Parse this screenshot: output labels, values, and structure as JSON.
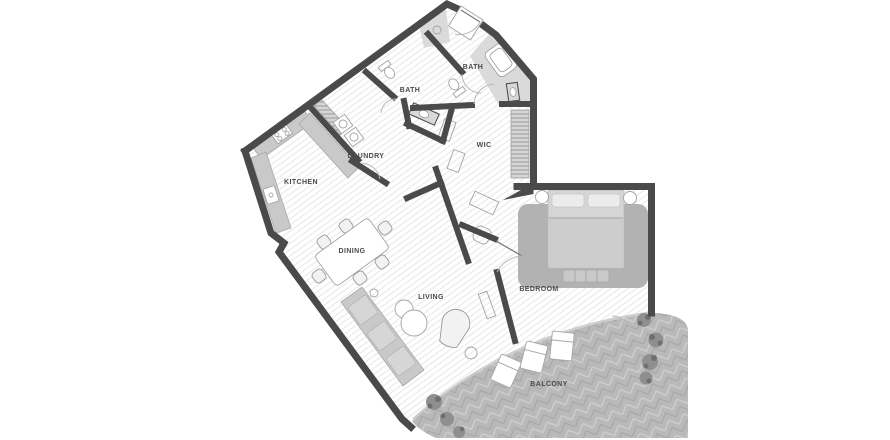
{
  "plan": {
    "rooms": {
      "kitchen": "KITCHEN",
      "laundry": "LAUNDRY",
      "bath_mid": "BATH",
      "bath_top": "BATH",
      "wic": "WIC",
      "dining": "DINING",
      "living": "LIVING",
      "bedroom": "BEDROOM",
      "balcony": "BALCONY"
    }
  },
  "colors": {
    "wall": "#4a4a4a",
    "floor": "#ffffff",
    "floor_hatch": "#e9e9e9",
    "furniture": "#c9c9c9",
    "rug": "#b2b2b2",
    "bed": "#d5d5d5",
    "balcony_floor": "#b9b9b9",
    "balcony_weave_light": "#cecece",
    "balcony_weave_dark": "#a6a6a6",
    "plant": "#8f8f8f",
    "plant_dark": "#6f6f6f",
    "label": "#4b4b4b",
    "door": "#b9b9b9",
    "glass": "#cdcdcd",
    "fixture_outline": "#a3a3a3",
    "shower_zone": "#dadada",
    "closet_stripe": "#9b9b9b",
    "closet_bg": "#d6d6d6"
  }
}
